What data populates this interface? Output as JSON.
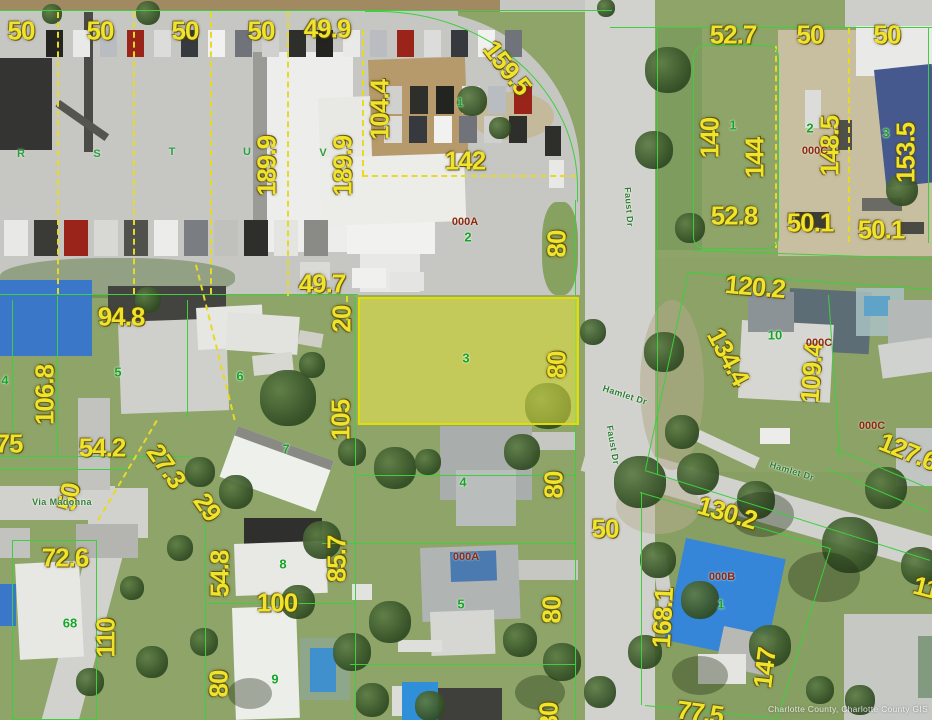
{
  "map": {
    "highlighted_parcel": {
      "lot_number": "3",
      "fill_color": "rgba(235,235,70,0.5)",
      "border_color": "#e0e000"
    },
    "colors": {
      "dimension_text": "#efe32b",
      "lot_number_text": "#17a328",
      "unit_text": "#8a2a12",
      "street_text": "#2e7d32",
      "parcel_line": "#3ecf3e",
      "survey_dash": "#e9d927"
    },
    "dimension_labels": [
      {
        "t": "50",
        "x": 21,
        "y": 31
      },
      {
        "t": "50",
        "x": 100,
        "y": 31
      },
      {
        "t": "50",
        "x": 185,
        "y": 31
      },
      {
        "t": "50",
        "x": 261,
        "y": 31
      },
      {
        "t": "49.9",
        "x": 327,
        "y": 29
      },
      {
        "t": "159.5",
        "x": 507,
        "y": 68,
        "r": 52
      },
      {
        "t": "104.4",
        "x": 380,
        "y": 110,
        "r": -90
      },
      {
        "t": "189.9",
        "x": 267,
        "y": 166,
        "r": -90
      },
      {
        "t": "189.9",
        "x": 343,
        "y": 166,
        "r": -90
      },
      {
        "t": "142",
        "x": 465,
        "y": 161
      },
      {
        "t": "80",
        "x": 557,
        "y": 244,
        "r": -90
      },
      {
        "t": "52.7",
        "x": 733,
        "y": 35
      },
      {
        "t": "50",
        "x": 810,
        "y": 35
      },
      {
        "t": "50",
        "x": 887,
        "y": 35
      },
      {
        "t": "140",
        "x": 710,
        "y": 138,
        "r": -90
      },
      {
        "t": "144",
        "x": 755,
        "y": 158,
        "r": -90
      },
      {
        "t": "148.5",
        "x": 830,
        "y": 146,
        "r": -90
      },
      {
        "t": "153.5",
        "x": 906,
        "y": 153,
        "r": -90
      },
      {
        "t": "52.8",
        "x": 734,
        "y": 216
      },
      {
        "t": "50.1",
        "x": 810,
        "y": 223
      },
      {
        "t": "50.1",
        "x": 881,
        "y": 230
      },
      {
        "t": "49.7",
        "x": 322,
        "y": 284
      },
      {
        "t": "94.8",
        "x": 121,
        "y": 317
      },
      {
        "t": "20",
        "x": 342,
        "y": 319,
        "r": -90
      },
      {
        "t": "106.8",
        "x": 45,
        "y": 395,
        "r": -90
      },
      {
        "t": "105",
        "x": 341,
        "y": 420,
        "r": -90
      },
      {
        "t": "80",
        "x": 557,
        "y": 365,
        "r": -90
      },
      {
        "t": "120.2",
        "x": 755,
        "y": 287,
        "r": 5
      },
      {
        "t": "134.4",
        "x": 728,
        "y": 357,
        "r": 62
      },
      {
        "t": "109.4",
        "x": 812,
        "y": 373,
        "r": -86
      },
      {
        "t": "127.6",
        "x": 908,
        "y": 452,
        "r": 22
      },
      {
        "t": "75",
        "x": 9,
        "y": 444
      },
      {
        "t": "54.2",
        "x": 102,
        "y": 448
      },
      {
        "t": "27.3",
        "x": 166,
        "y": 466,
        "r": 55
      },
      {
        "t": "29",
        "x": 207,
        "y": 507,
        "r": 55
      },
      {
        "t": "50",
        "x": 69,
        "y": 497,
        "r": -78
      },
      {
        "t": "72.6",
        "x": 65,
        "y": 558
      },
      {
        "t": "54.8",
        "x": 220,
        "y": 574,
        "r": -90
      },
      {
        "t": "100",
        "x": 277,
        "y": 603
      },
      {
        "t": "110",
        "x": 106,
        "y": 638,
        "r": -90
      },
      {
        "t": "80",
        "x": 219,
        "y": 684,
        "r": -90
      },
      {
        "t": "85.7",
        "x": 337,
        "y": 559,
        "r": -90
      },
      {
        "t": "80",
        "x": 554,
        "y": 485,
        "r": -90
      },
      {
        "t": "80",
        "x": 552,
        "y": 610,
        "r": -90
      },
      {
        "t": "50",
        "x": 605,
        "y": 529
      },
      {
        "t": "80",
        "x": 549,
        "y": 716,
        "r": -90
      },
      {
        "t": "130.2",
        "x": 727,
        "y": 513,
        "r": 16
      },
      {
        "t": "168.1",
        "x": 663,
        "y": 618,
        "r": -87
      },
      {
        "t": "147",
        "x": 765,
        "y": 668,
        "r": -83
      },
      {
        "t": "77.5",
        "x": 700,
        "y": 713,
        "r": 8
      },
      {
        "t": "11",
        "x": 926,
        "y": 588,
        "r": 14
      }
    ],
    "lot_numbers": [
      {
        "t": "1",
        "x": 460,
        "y": 102
      },
      {
        "t": "2",
        "x": 468,
        "y": 237
      },
      {
        "t": "1",
        "x": 733,
        "y": 125
      },
      {
        "t": "2",
        "x": 810,
        "y": 128
      },
      {
        "t": "3",
        "x": 886,
        "y": 133
      },
      {
        "t": "4",
        "x": 5,
        "y": 380
      },
      {
        "t": "5",
        "x": 118,
        "y": 372
      },
      {
        "t": "6",
        "x": 240,
        "y": 376
      },
      {
        "t": "7",
        "x": 286,
        "y": 449
      },
      {
        "t": "10",
        "x": 775,
        "y": 335
      },
      {
        "t": "3",
        "x": 466,
        "y": 358
      },
      {
        "t": "4",
        "x": 463,
        "y": 482
      },
      {
        "t": "5",
        "x": 461,
        "y": 604
      },
      {
        "t": "8",
        "x": 283,
        "y": 564
      },
      {
        "t": "68",
        "x": 70,
        "y": 623
      },
      {
        "t": "9",
        "x": 275,
        "y": 679
      },
      {
        "t": "1",
        "x": 721,
        "y": 604
      }
    ],
    "block_letters": [
      {
        "t": "R",
        "x": 21,
        "y": 154
      },
      {
        "t": "S",
        "x": 97,
        "y": 154
      },
      {
        "t": "T",
        "x": 172,
        "y": 152
      },
      {
        "t": "U",
        "x": 247,
        "y": 152
      },
      {
        "t": "V",
        "x": 323,
        "y": 153
      }
    ],
    "unit_labels": [
      {
        "t": "000A",
        "x": 465,
        "y": 222
      },
      {
        "t": "000C",
        "x": 815,
        "y": 151
      },
      {
        "t": "000C",
        "x": 819,
        "y": 343
      },
      {
        "t": "000C",
        "x": 872,
        "y": 426
      },
      {
        "t": "000A",
        "x": 466,
        "y": 557
      },
      {
        "t": "000B",
        "x": 722,
        "y": 577
      }
    ],
    "streets": [
      {
        "t": "Faust Dr",
        "x": 629,
        "y": 207,
        "r": 86
      },
      {
        "t": "Faust Dr",
        "x": 613,
        "y": 445,
        "r": 80
      },
      {
        "t": "Hamlet Dr",
        "x": 625,
        "y": 395,
        "r": 18
      },
      {
        "t": "Hamlet Dr",
        "x": 792,
        "y": 471,
        "r": 17
      },
      {
        "t": "Via Madonna",
        "x": 62,
        "y": 502,
        "r": 0
      }
    ],
    "watermark": "Charlotte County, Charlotte County GIS"
  }
}
